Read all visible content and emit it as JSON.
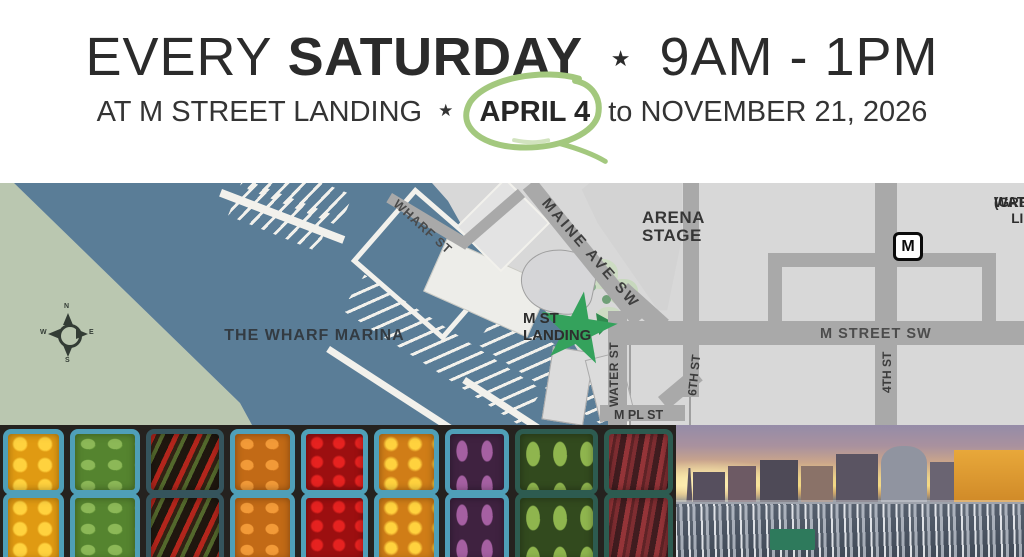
{
  "header": {
    "line1": {
      "word1": "EVERY",
      "word2": "SATURDAY",
      "separator": "★",
      "time": "9AM - 1PM"
    },
    "line2": {
      "prefix": "AT M STREET LANDING",
      "separator": "★",
      "circled_date": "APRIL 4",
      "connector": "to",
      "end_date": "NOVEMBER 21, 2026"
    }
  },
  "map": {
    "labels": {
      "marina": "THE WHARF MARINA",
      "wharf_st": "WHARF ST",
      "maine_ave": "MAINE AVE SW",
      "arena_line1": "ARENA",
      "arena_line2": "STAGE",
      "landing_line1": "M ST",
      "landing_line2": "LANDING",
      "water_st": "WATER ST",
      "sixth_st": "6TH ST",
      "m_pl_st": "M PL ST",
      "m_street_sw": "M STREET SW",
      "fourth_st": "4TH ST",
      "metro_line1": "WATERFRONT METRO STATION",
      "metro_line2": "(GREEN LINE)",
      "metro_logo": "M"
    },
    "compass": {
      "n": "N",
      "e": "E",
      "s": "S",
      "w": "W"
    }
  },
  "colors": {
    "text_dark": "#2b2b2b",
    "circle_green": "#a3c87e",
    "star_green": "#34a25c",
    "water_blue": "#5a7d97",
    "land_green": "#bac7b0",
    "city_gray": "#d8d8d8",
    "road_gray": "#a9a9a9",
    "dock_white": "#f2f1ec",
    "basket_teal": "#4f9fb8",
    "basket_green": "#2d5b50",
    "strip_bg": "#211f1d"
  }
}
